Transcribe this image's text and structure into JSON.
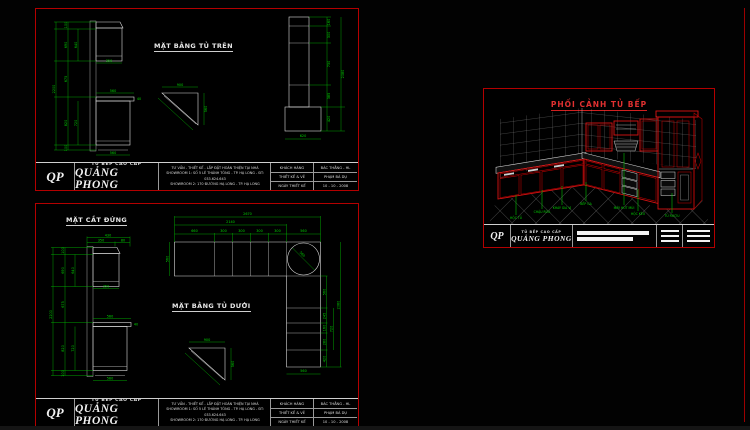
{
  "page": {
    "background": "#000000"
  },
  "colors": {
    "sheet_border": "#b40000",
    "dimension_green": "#00d400",
    "line_white": "#dcdcdc",
    "cabinet_red": "#d91111",
    "glass_yellow": "#d8d800"
  },
  "titleblock": {
    "logo": "QP",
    "company_top": "TỦ BẾP CAO CẤP",
    "company_name": "QUẢNG PHONG",
    "info_lines": [
      "TƯ VẤN - THIẾT KẾ - LẮP ĐẶT HOÀN THIỆN TẠI NHÀ",
      "SHOWROOM 1: SỐ 5 LÊ THÁNH TÔNG - TP. HẠ LONG - ĐT: 033.624.643",
      "SHOWROOM 2: 170 ĐƯỜNG HẠ LONG - TP. HẠ LONG"
    ],
    "rows": [
      {
        "label": "KHÁCH HÀNG",
        "value": "BÁC THẮNG - HL"
      },
      {
        "label": "THIẾT KẾ & VẼ",
        "value": "PHẠM BÁ DỤ"
      },
      {
        "label": "NGÀY THIẾT KẾ",
        "value": "10 - 10 - 2008"
      }
    ]
  },
  "sheet_top": {
    "plan_label": "MẶT BẰNG TỦ TRÊN",
    "strip": {
      "dims": [
        "160",
        "300",
        "730",
        "385",
        "420"
      ],
      "total": "2080",
      "width": "620"
    }
  },
  "sheet_bottom": {
    "section_label": "MẶT CẮT ĐỨNG",
    "plan_label": "MẶT BẰNG TỦ DƯỚI",
    "lplan": {
      "top_segments": [
        "660",
        "300",
        "300",
        "300",
        "300",
        "560"
      ],
      "chain": "2140",
      "total": "2670",
      "left": "560",
      "circle": "560",
      "right_segments": [
        "560",
        "245",
        "160",
        "280",
        "420"
      ],
      "right_bracket": "720",
      "right_total": "2080",
      "bottom": "560"
    }
  },
  "elevation": {
    "top_total": "430",
    "top_a": "350",
    "top_b": "80",
    "left_total": "2200",
    "seg_top": "100",
    "seg_upper": "690",
    "seg_mid": "675",
    "seg_lower": "820",
    "seg_base": "100",
    "inner_upper": "640",
    "inner_lower": "720",
    "w_upper": "350",
    "w_counter": "560",
    "w_counter_t": "40",
    "w_bottom": "560"
  },
  "triangle": {
    "top": "900",
    "side": "560"
  },
  "perspective": {
    "title": "PHỐI CẢNH TỦ BẾP",
    "labels": [
      "HỘC TỦ",
      "CHẬU RỬA",
      "KHAY GIA VỊ",
      "BẾP GA",
      "MÁY HÚT MÙI",
      "HỘC KÉO",
      "TỦ RƯỢU"
    ]
  }
}
